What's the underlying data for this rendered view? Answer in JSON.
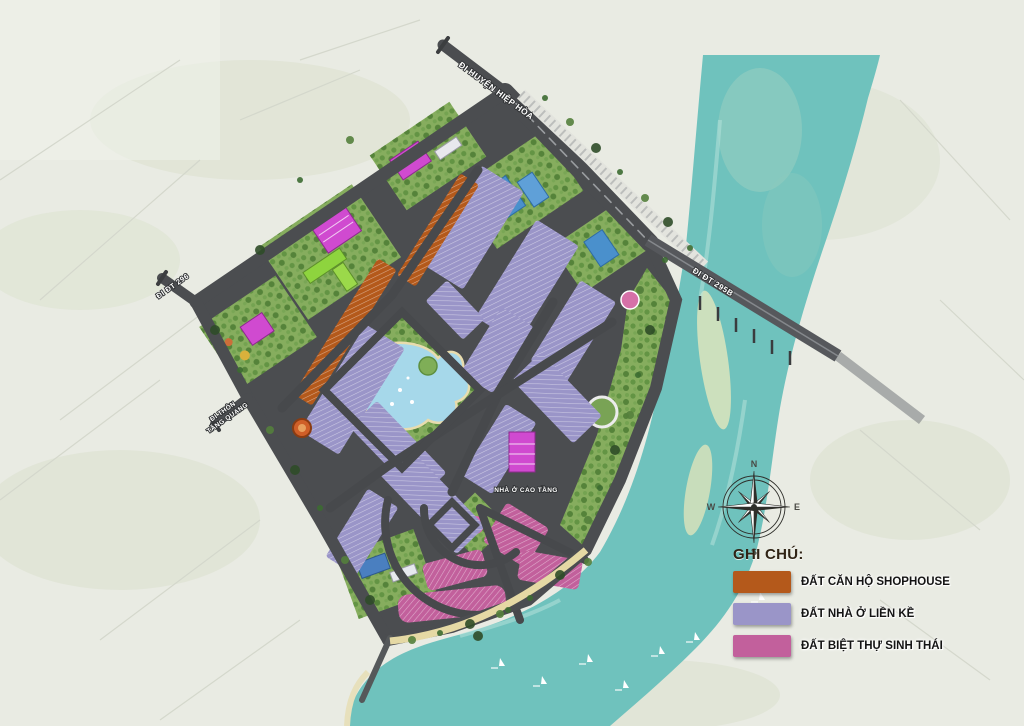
{
  "legend": {
    "title": "GHI CHÚ:",
    "items": [
      {
        "label": "ĐẤT CĂN HỘ SHOPHOUSE",
        "color": "#b4591b"
      },
      {
        "label": "ĐẤT NHÀ Ở LIỀN KỀ",
        "color": "#9a95c8"
      },
      {
        "label": "ĐẤT BIỆT THỰ SINH THÁI",
        "color": "#c2609c"
      }
    ]
  },
  "roads": {
    "to_hiep_hoa": "ĐI HUYỆN HIỆP HÒA",
    "to_dt295b": "ĐI ĐT 295B",
    "to_dt296": "ĐI ĐT 296",
    "to_thon_line1": "ĐI THÔN",
    "to_thon_line2": "TĂNG QUANG"
  },
  "labels": {
    "high_rise": "NHÀ Ở CAO TẦNG"
  },
  "compass": {
    "n": "N",
    "e": "E",
    "s": "S",
    "w": "W"
  },
  "colors": {
    "river": "#6fc2bd",
    "road": "#4b4d50",
    "park": "#86ad5e",
    "lake": "#a6d8ea",
    "sand": "#e5d9a4",
    "land": "#e9ebe3",
    "building_magenta": "#d04ad0",
    "building_blue": "#4a90cc",
    "building_lime": "#8ed43e"
  }
}
